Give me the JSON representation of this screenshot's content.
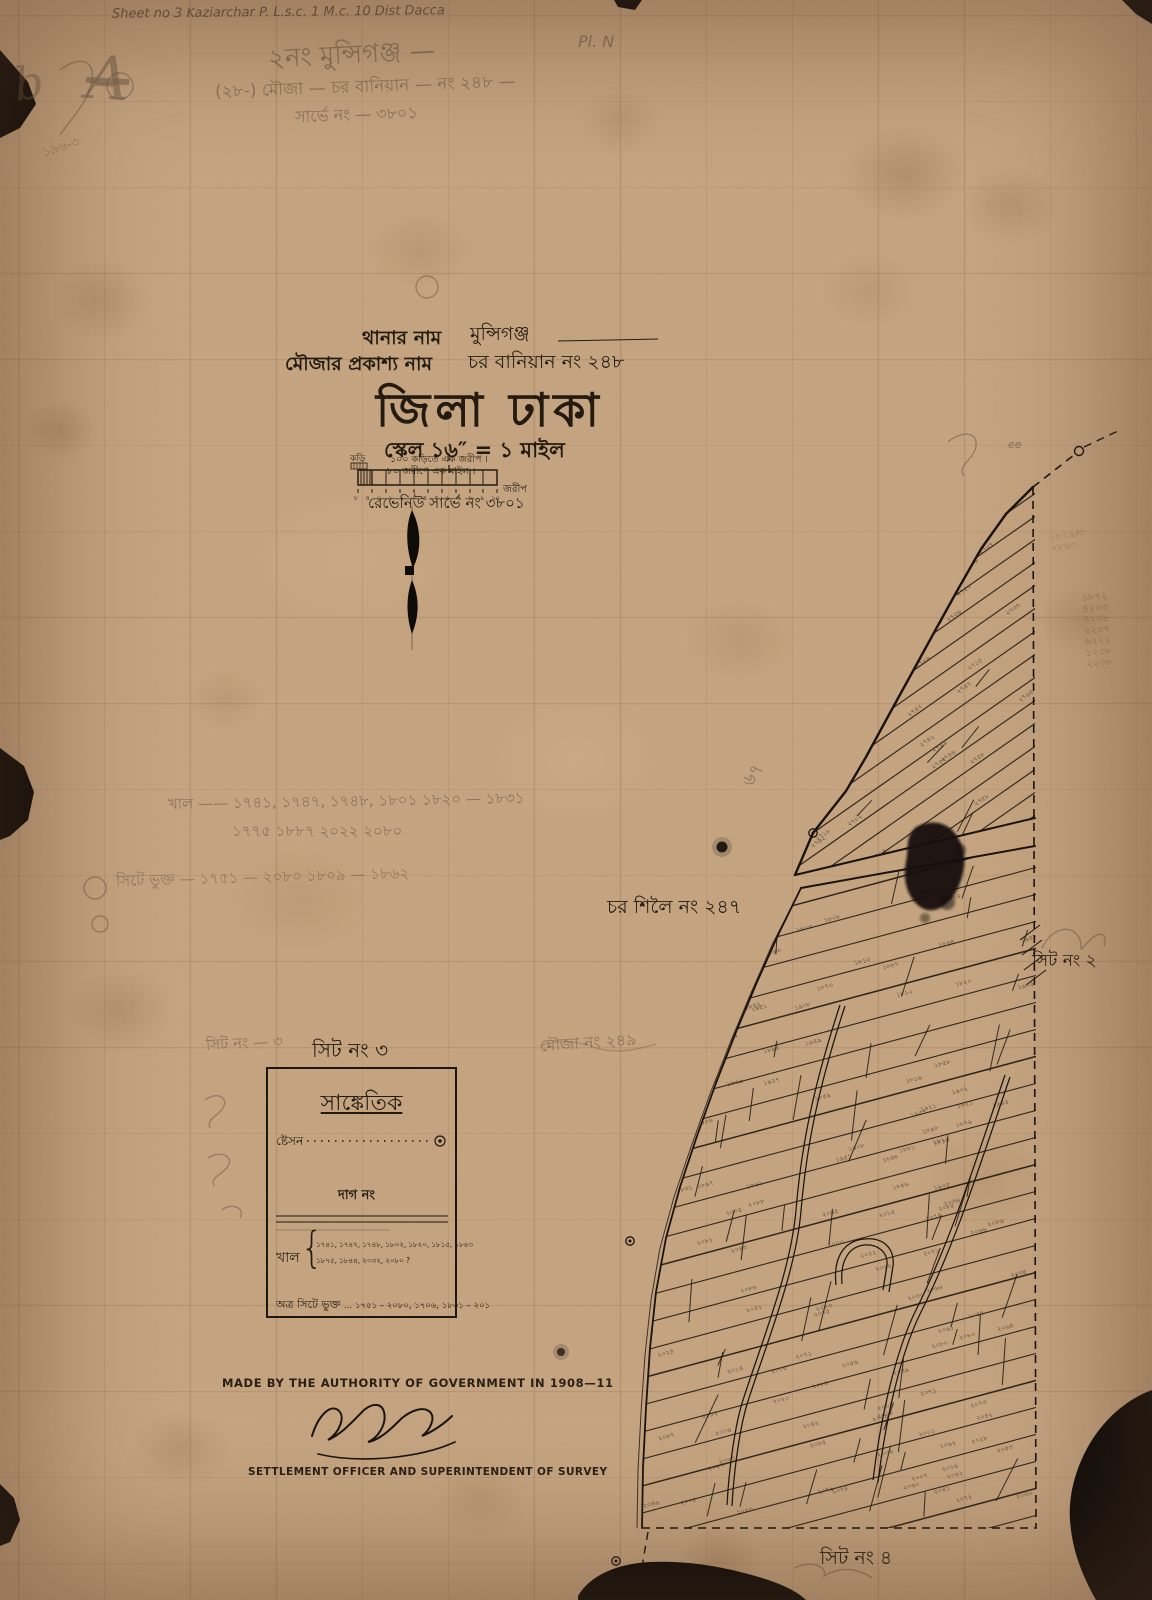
{
  "colors": {
    "paper": "#c6a581",
    "ink": "#241b10",
    "pencil": "#6f5e4c",
    "torn_black": "#0b0908"
  },
  "annotations": {
    "sheet_note": "Sheet no 3  Kaziarchar P. L.s.c. 1 M.c. 10 Dist Dacca",
    "pl_note": "Pl. N",
    "monogram": "A",
    "monogram_b": "b",
    "pencil_small_left": "১৯৬-৩",
    "pencil_line1": "২নং  মুন্সিগঞ্জ —",
    "pencil_line2": "(২৮-) মৌজা —  চর বানিয়ান — নং ২৪৮ —",
    "pencil_line3": "সার্ভে নং — ৩৮০১",
    "khal_pencil1": "খাল ——  ১৭৪১, ১৭৪৭, ১৭৪৮,  ১৮০১  ১৮২০ — ১৮৩১",
    "khal_pencil2": "১৭৭৫  ১৮৮৭   ২০২২   ২০৮০",
    "pencil_row3": "সিটে ভুক্ত — ১৭৫১ — ২০৮০   ১৮০৯ — ১৮৬২",
    "pencil_249": "মৌজা নং ২৪৯",
    "pencil_sheet3": "সিট নং — ৩",
    "pencil_ee": "ee",
    "pencil_67": "৬৭",
    "right_pencil_numbers": [
      "১৮৭২",
      "৪২০৩",
      "৪২০৮",
      "২২৩৭",
      "৬২২২",
      "১২৩৮",
      "২২০৮"
    ],
    "near_blob_pencil": [
      "১৮৭৯/৩",
      "২৮৬০"
    ]
  },
  "title_block": {
    "thana_label": "থানার নাম",
    "thana_value": "মুন্সিগঞ্জ",
    "mouza_label": "মৌজার প্রকাশ্য নাম",
    "mouza_value": "চর বানিয়ান নং ২৪৮",
    "district": "জিলা ঢাকা",
    "scale": "স্কেল ১৬″ = ১ মাইল",
    "revenue": "রেভেনিউ সার্ভে নং ৩৮০১"
  },
  "scale_bar": {
    "note1": "১০০ কড়িতে এক জরীপ ।",
    "note2": "৮০ জরীপে এক মাইল ।",
    "left_unit": "কড়ি",
    "right_unit": "জরীপ",
    "tick_labels": [
      "৮",
      "৪",
      "০",
      "১",
      "২",
      "৩",
      "৪",
      "৫",
      "৬",
      "৭",
      "৮",
      "৯",
      "১০"
    ]
  },
  "map_labels": {
    "char_shiloi": "চর শিলৈ নং ২৪৭",
    "sheet_2": "সিট নং ২",
    "sheet_3": "সিট নং ৩",
    "sheet_4": "সিট নং ৪"
  },
  "legend": {
    "title": "সাঙ্কেতিক",
    "station_label": "ষ্টেসন",
    "dag_label": "দাগ নং",
    "khal_label": "খাল",
    "khal_brace": "{",
    "khal_line1": "১৭৪১, ১৭৪৭, ১৭৪৮, ১৮০২, ১৮২০, ১৮১৫, ১৮৪৩",
    "khal_line2": "১৮৭৫, ১৮৪৪, ২০৩২, ২০৮০ ?",
    "included_label": "অত্র সিটে ভুক্ত",
    "included_values": "… ১৭৫১ – ২০৮০, ১৭০৬, ১৮৩১ – ২০১"
  },
  "footer": {
    "authority": "MADE BY THE AUTHORITY OF GOVERNMENT IN 1908—11",
    "office": "SETTLEMENT OFFICER AND SUPERINTENDENT OF SURVEY"
  }
}
